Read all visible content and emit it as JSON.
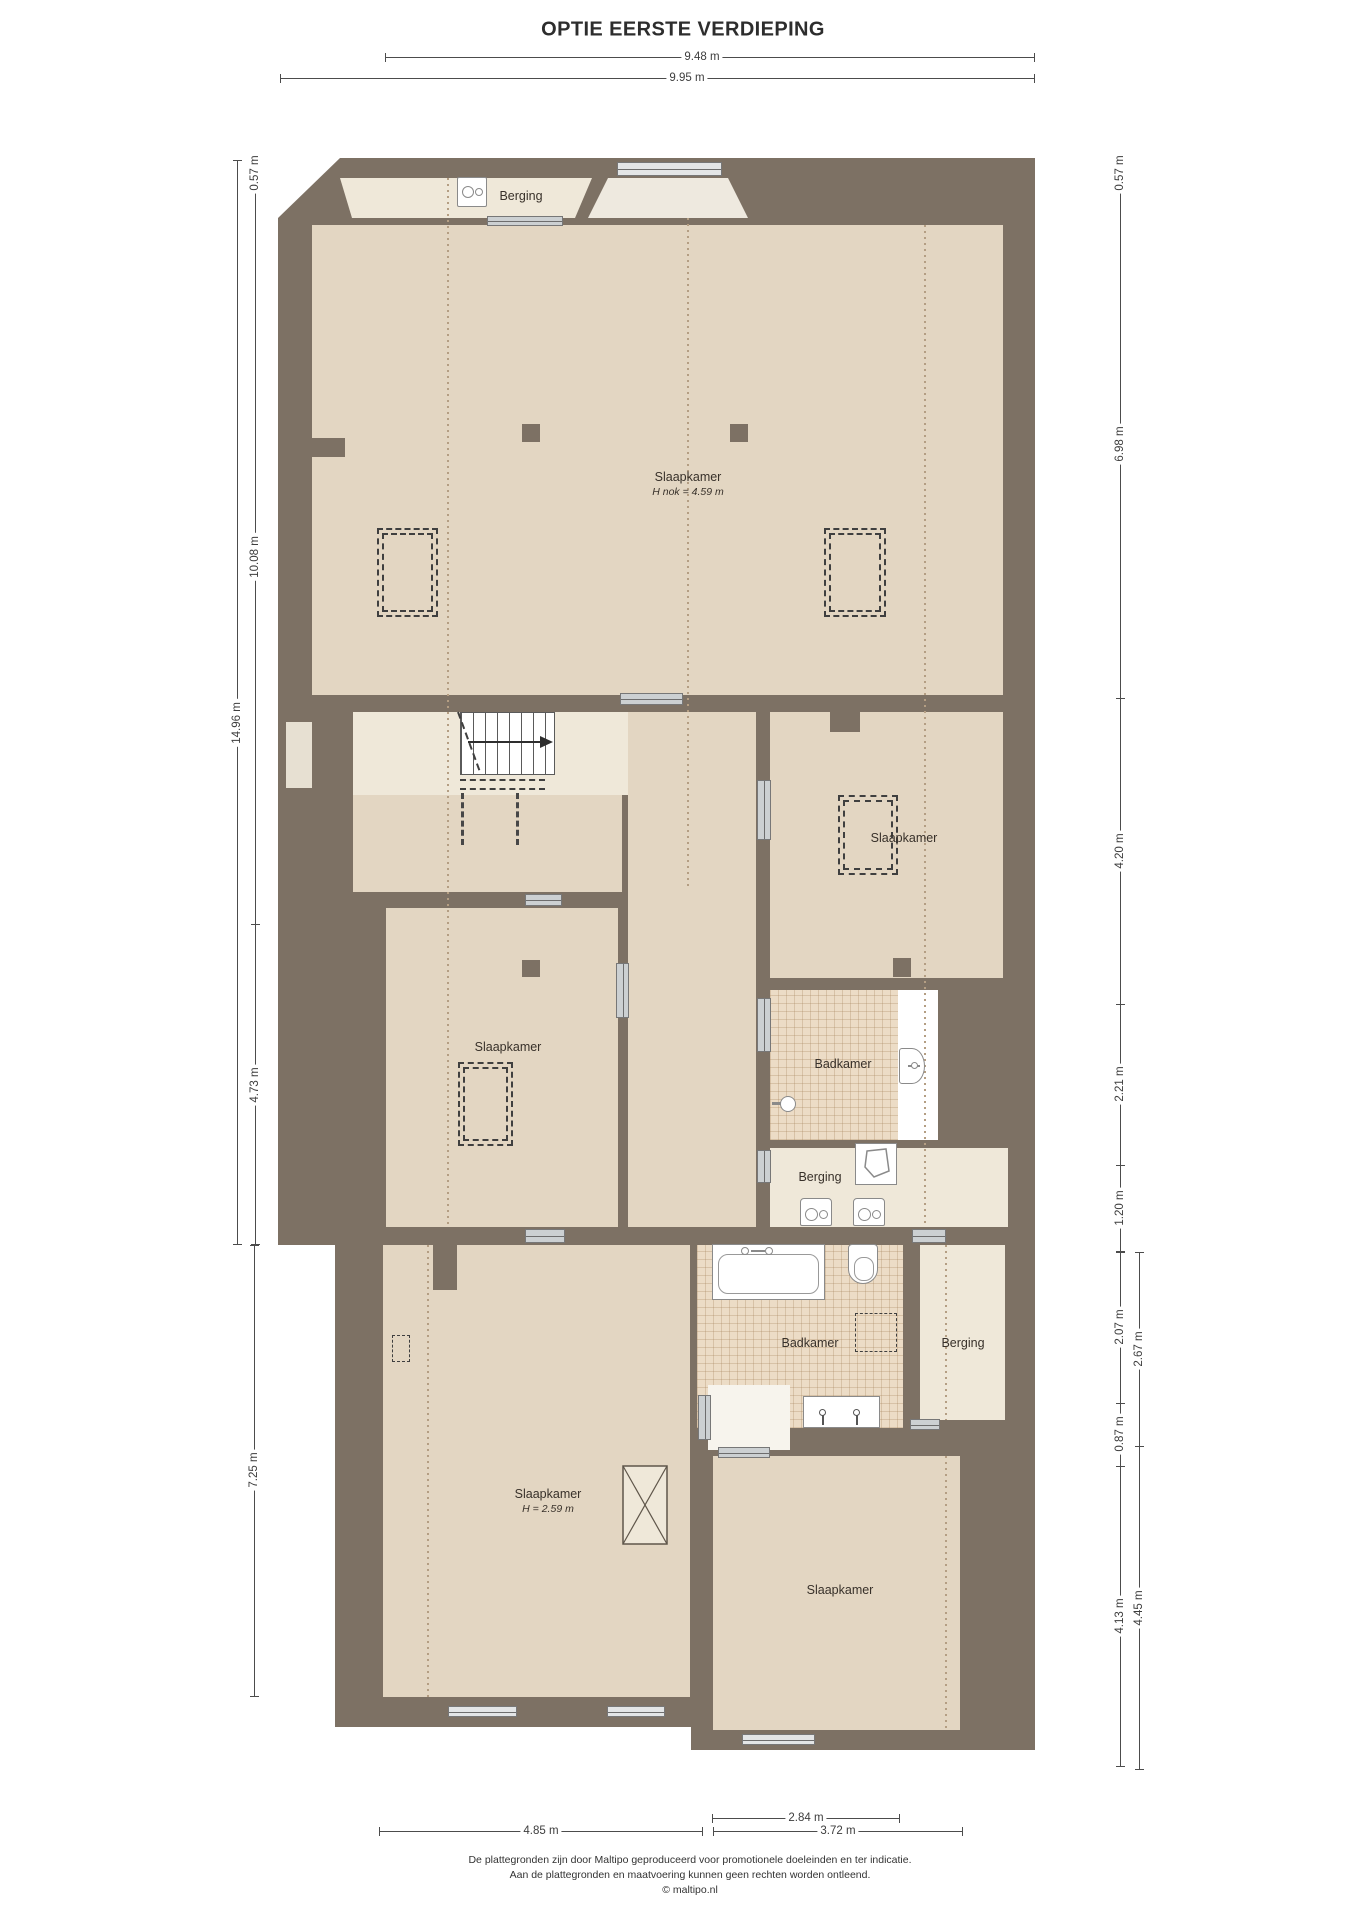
{
  "title": "OPTIE EERSTE VERDIEPING",
  "colors": {
    "wall": "#7d7164",
    "floor": "#e3d6c2",
    "floor_light": "#efe8d9",
    "tile": "#ecdcc6",
    "door_fill": "#ccd0d2",
    "dotted": "#b49e83",
    "dim": "#4c4c4c",
    "fixture_line": "#8a8a8a",
    "text": "#38312a"
  },
  "rooms": {
    "berging_top": {
      "label": "Berging"
    },
    "slaapkamer_main": {
      "label": "Slaapkamer",
      "height_note": "H nok = 4.59 m"
    },
    "slaapkamer_right": {
      "label": "Slaapkamer"
    },
    "slaapkamer_mid_left": {
      "label": "Slaapkamer"
    },
    "badkamer_mid": {
      "label": "Badkamer"
    },
    "berging_mid": {
      "label": "Berging"
    },
    "badkamer_lower": {
      "label": "Badkamer"
    },
    "berging_lower": {
      "label": "Berging"
    },
    "slaapkamer_bottom_left": {
      "label": "Slaapkamer",
      "height_note": "H = 2.59 m"
    },
    "slaapkamer_bottom_right": {
      "label": "Slaapkamer"
    }
  },
  "dimensions": {
    "top_inner": "9.48 m",
    "top_outer": "9.95 m",
    "left_top": "0.57 m",
    "left_upper": "10.08 m",
    "left_total": "14.96 m",
    "left_lower": "4.73 m",
    "left_bottom": "7.25 m",
    "right_top": "0.57 m",
    "right_upper": "6.98 m",
    "right_mid": "4.20 m",
    "right_lower": "2.21 m",
    "right_small": "1.20 m",
    "right_b1": "2.07 m",
    "right_b1_outer": "2.67 m",
    "right_b2": "0.87 m",
    "right_b3": "4.13 m",
    "right_b3_outer": "4.45 m",
    "bottom_mid": "2.84 m",
    "bottom_left": "4.85 m",
    "bottom_right": "3.72 m"
  },
  "icons": {
    "washer": "washing-machine-icon",
    "boiler": "boiler-icon",
    "bath": "bathtub-icon",
    "toilet": "toilet-icon",
    "sink": "washbasin-icon",
    "shower": "shower-head-icon",
    "stairs_arrow": "arrow-right-icon"
  },
  "footer": {
    "lines": [
      "De plattegronden zijn door Maltipo geproduceerd voor promotionele doeleinden en ter indicatie.",
      "Aan de plattegronden en maatvoering kunnen geen rechten worden ontleend.",
      "© maltipo.nl"
    ]
  }
}
